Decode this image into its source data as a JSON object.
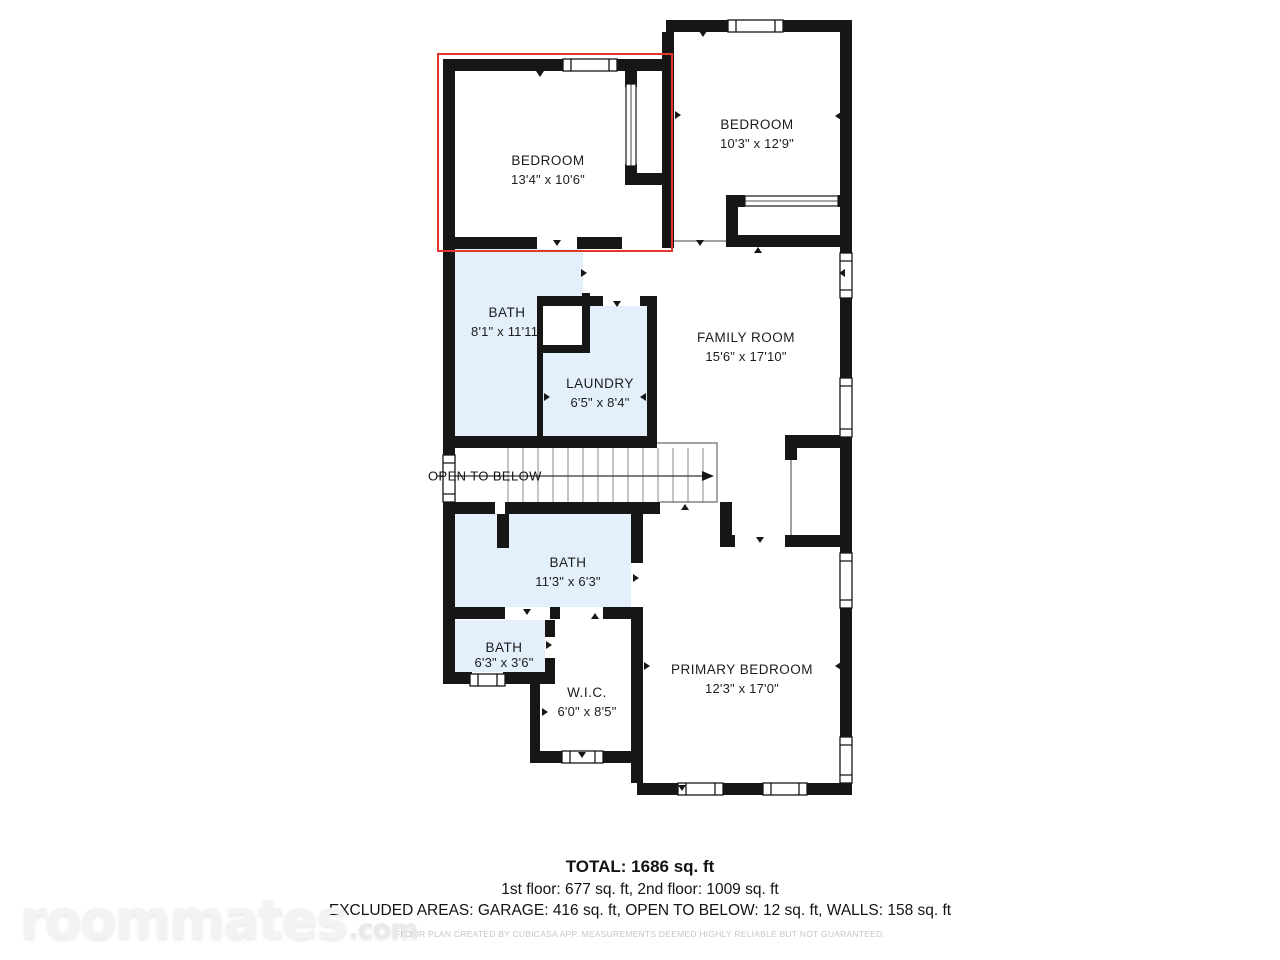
{
  "floorplan": {
    "highlight_color": "#e2372b",
    "wall_color": "#161616",
    "wet_room_fill": "#e3effa",
    "rooms": [
      {
        "id": "bedroom-1",
        "name": "BEDROOM",
        "dims": "13'4\" x 10'6\"",
        "highlighted": true
      },
      {
        "id": "bedroom-2",
        "name": "BEDROOM",
        "dims": "10'3\" x 12'9\"",
        "highlighted": false
      },
      {
        "id": "bath-1",
        "name": "BATH",
        "dims": "8'1\" x 11'11\"",
        "highlighted": false
      },
      {
        "id": "laundry",
        "name": "LAUNDRY",
        "dims": "6'5\" x 8'4\"",
        "highlighted": false
      },
      {
        "id": "family-room",
        "name": "FAMILY ROOM",
        "dims": "15'6\" x 17'10\"",
        "highlighted": false
      },
      {
        "id": "bath-2",
        "name": "BATH",
        "dims": "11'3\" x 6'3\"",
        "highlighted": false
      },
      {
        "id": "bath-3",
        "name": "BATH",
        "dims": "6'3\" x 3'6\"",
        "highlighted": false
      },
      {
        "id": "wic",
        "name": "W.I.C.",
        "dims": "6'0\" x 8'5\"",
        "highlighted": false
      },
      {
        "id": "primary-bedroom",
        "name": "PRIMARY BEDROOM",
        "dims": "12'3\" x 17'0\"",
        "highlighted": false
      }
    ],
    "annotations": {
      "open_to_below": "OPEN TO BELOW"
    }
  },
  "summary": {
    "total": "TOTAL: 1686 sq. ft",
    "floors": "1st floor: 677 sq. ft, 2nd floor: 1009 sq. ft",
    "excluded_areas": "EXCLUDED AREAS: GARAGE: 416 sq. ft, OPEN TO BELOW: 12 sq. ft, WALLS: 158 sq. ft",
    "disclaimer": "FLOOR PLAN CREATED BY CUBICASA APP. MEASUREMENTS DEEMED HIGHLY RELIABLE BUT NOT GUARANTEED."
  },
  "watermark": {
    "brand": "roommates",
    "tld": ".com"
  }
}
